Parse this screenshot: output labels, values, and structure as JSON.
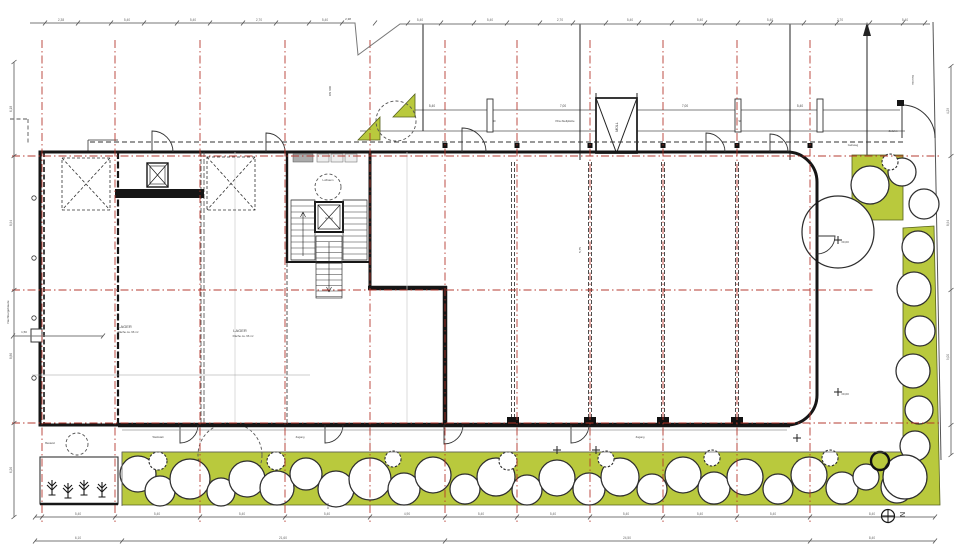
{
  "meta": {
    "drawing_type": "Erdgeschoss Lageplan",
    "north_label": "N"
  },
  "colors": {
    "landscape_green": "#b9c93d",
    "grid_red": "#b23026",
    "wall_black": "#161616",
    "paper_white": "#ffffff"
  },
  "grid": {
    "vertical_axes_x": [
      42,
      115,
      200,
      285,
      370,
      445,
      517,
      590,
      663,
      737,
      810
    ],
    "horizontal_axes": [
      {
        "y": 156,
        "x1": 12,
        "x2": 940
      },
      {
        "y": 290,
        "x1": 12,
        "x2": 875
      },
      {
        "y": 423,
        "x1": 12,
        "x2": 940
      }
    ]
  },
  "building": {
    "partitions_x": [
      513,
      590,
      663,
      737
    ],
    "partition_flags_x": [
      445,
      517,
      590,
      663,
      737,
      810
    ],
    "walkway_dividers_x": [
      200,
      285,
      370,
      445,
      517,
      590,
      663,
      737
    ]
  },
  "yard": {
    "fence_posts_x": [
      487,
      735,
      817
    ]
  },
  "landscape": {
    "tree_row": [
      [
        138,
        474,
        18
      ],
      [
        160,
        491,
        15
      ],
      [
        190,
        479,
        20
      ],
      [
        221,
        492,
        14
      ],
      [
        247,
        479,
        18
      ],
      [
        277,
        488,
        17
      ],
      [
        306,
        474,
        16
      ],
      [
        336,
        489,
        18
      ],
      [
        370,
        479,
        21
      ],
      [
        404,
        489,
        16
      ],
      [
        433,
        475,
        18
      ],
      [
        465,
        489,
        15
      ],
      [
        496,
        477,
        19
      ],
      [
        527,
        490,
        15
      ],
      [
        557,
        478,
        18
      ],
      [
        589,
        489,
        16
      ],
      [
        620,
        477,
        19
      ],
      [
        652,
        489,
        15
      ],
      [
        683,
        475,
        18
      ],
      [
        714,
        488,
        16
      ],
      [
        745,
        477,
        18
      ],
      [
        778,
        489,
        15
      ],
      [
        809,
        475,
        18
      ],
      [
        842,
        488,
        16
      ],
      [
        866,
        477,
        13
      ],
      [
        897,
        487,
        16
      ]
    ],
    "right_trees": [
      [
        838,
        232,
        36
      ],
      [
        870,
        185,
        19
      ],
      [
        902,
        172,
        14
      ],
      [
        924,
        204,
        15
      ],
      [
        918,
        247,
        16
      ],
      [
        914,
        289,
        17
      ],
      [
        920,
        331,
        15
      ],
      [
        913,
        371,
        17
      ],
      [
        919,
        410,
        14
      ],
      [
        915,
        446,
        15
      ],
      [
        905,
        477,
        22
      ]
    ],
    "bushes": [
      [
        158,
        461,
        9
      ],
      [
        276,
        461,
        9
      ],
      [
        393,
        459,
        8
      ],
      [
        508,
        461,
        9
      ],
      [
        606,
        459,
        8
      ],
      [
        712,
        458,
        8
      ],
      [
        830,
        458,
        8
      ],
      [
        890,
        162,
        8
      ]
    ],
    "dark_tree": [
      880,
      461,
      9
    ],
    "existing_trees_dashed": [
      [
        230,
        455,
        32
      ],
      [
        77,
        444,
        11
      ],
      [
        396,
        121,
        20
      ]
    ],
    "planter_plants": [
      [
        52,
        495
      ],
      [
        68,
        498
      ],
      [
        84,
        495
      ],
      [
        102,
        497
      ]
    ]
  },
  "labels": [
    {
      "t": "LAGER",
      "x": 125,
      "y": 328,
      "s": 4
    },
    {
      "t": "Fläche ca. 96 m²",
      "x": 128,
      "y": 333,
      "s": 2.8
    },
    {
      "t": "LAGER",
      "x": 240,
      "y": 332,
      "s": 4
    },
    {
      "t": "Fläche ca. 96 m²",
      "x": 243,
      "y": 337,
      "s": 2.8
    },
    {
      "t": "Luftraum",
      "x": 328,
      "y": 181,
      "s": 2.8
    },
    {
      "t": "Aufzug",
      "x": 329,
      "y": 219,
      "s": 2.6
    },
    {
      "t": "MÜLL",
      "x": 618,
      "y": 127,
      "s": 3.6,
      "r": -90
    },
    {
      "t": "DN 600",
      "x": 331,
      "y": 91,
      "s": 3,
      "r": -90
    },
    {
      "t": "5,75",
      "x": 581,
      "y": 250,
      "s": 3,
      "r": -90
    },
    {
      "t": "0,90",
      "x": 329,
      "y": 506,
      "s": 3,
      "r": -90
    },
    {
      "t": "1,50",
      "x": 24,
      "y": 333,
      "s": 3
    },
    {
      "t": "5,40",
      "x": 432,
      "y": 107,
      "s": 3.2
    },
    {
      "t": "7,00",
      "x": 563,
      "y": 107,
      "s": 3.2
    },
    {
      "t": "7,00",
      "x": 685,
      "y": 107,
      "s": 3.2
    },
    {
      "t": "5,40",
      "x": 800,
      "y": 107,
      "s": 3.2
    },
    {
      "t": "90",
      "x": 494,
      "y": 122,
      "s": 2.8
    },
    {
      "t": "90",
      "x": 740,
      "y": 122,
      "s": 2.8
    },
    {
      "t": "Pkw-Stellplätze",
      "x": 565,
      "y": 122,
      "s": 2.8
    },
    {
      "t": "Gehweg",
      "x": 853,
      "y": 146,
      "s": 2.8
    },
    {
      "t": "Zufahrt",
      "x": 893,
      "y": 132,
      "s": 2.8
    },
    {
      "t": "Grenze",
      "x": 912,
      "y": 80,
      "s": 3,
      "r": 90
    },
    {
      "t": "Nachbargebäude",
      "x": 9,
      "y": 312,
      "s": 3,
      "r": -90
    },
    {
      "t": "Bestand",
      "x": 50,
      "y": 444,
      "s": 2.6
    },
    {
      "t": "±0,00",
      "x": 845,
      "y": 243,
      "s": 3
    },
    {
      "t": "±0,00",
      "x": 845,
      "y": 395,
      "s": 3
    },
    {
      "t": "Werkstatt",
      "x": 158,
      "y": 438,
      "s": 2.6
    },
    {
      "t": "Zugang",
      "x": 300,
      "y": 438,
      "s": 2.6
    },
    {
      "t": "Zugang",
      "x": 640,
      "y": 438,
      "s": 2.6
    },
    {
      "t": "2,38",
      "x": 348,
      "y": 20,
      "s": 3
    }
  ],
  "plus_marks": [
    [
      557,
      450
    ],
    [
      596,
      450
    ],
    [
      838,
      240
    ],
    [
      838,
      392
    ],
    [
      797,
      438
    ]
  ],
  "dimensions": {
    "chains": [
      {
        "name": "top",
        "dir": "h",
        "pos": 23,
        "line": [
          [
            30,
            23
          ],
          [
            355,
            23
          ],
          [
            358,
            55
          ],
          [
            400,
            24
          ],
          [
            930,
            24
          ]
        ],
        "ticks": [
          45,
          78,
          111,
          144,
          177,
          210,
          243,
          276,
          309,
          342,
          375,
          408,
          441,
          474,
          507,
          540,
          573,
          606,
          639,
          672,
          705,
          738,
          771,
          804,
          837,
          870,
          903,
          925
        ],
        "numbers": [
          {
            "v": "2,38",
            "p": 61
          },
          {
            "v": "5,40",
            "p": 127
          },
          {
            "v": "5,40",
            "p": 193
          },
          {
            "v": "2,70",
            "p": 259
          },
          {
            "v": "5,40",
            "p": 325
          },
          {
            "v": "5,40",
            "p": 420
          },
          {
            "v": "5,40",
            "p": 490
          },
          {
            "v": "2,70",
            "p": 560
          },
          {
            "v": "5,40",
            "p": 630
          },
          {
            "v": "5,40",
            "p": 700
          },
          {
            "v": "5,40",
            "p": 770
          },
          {
            "v": "2,70",
            "p": 840
          },
          {
            "v": "5,40",
            "p": 905
          }
        ]
      },
      {
        "name": "bottom-1",
        "dir": "h",
        "pos": 517,
        "line": [
          [
            35,
            517
          ],
          [
            935,
            517
          ]
        ],
        "ticks": [
          35,
          42,
          115,
          200,
          285,
          370,
          445,
          517,
          590,
          663,
          737,
          810,
          935
        ],
        "numbers": [
          {
            "v": "5,40",
            "p": 78
          },
          {
            "v": "5,40",
            "p": 157
          },
          {
            "v": "5,40",
            "p": 242
          },
          {
            "v": "5,40",
            "p": 327
          },
          {
            "v": "4,90",
            "p": 407
          },
          {
            "v": "5,40",
            "p": 481
          },
          {
            "v": "5,40",
            "p": 553
          },
          {
            "v": "5,40",
            "p": 626
          },
          {
            "v": "5,40",
            "p": 700
          },
          {
            "v": "5,40",
            "p": 773
          },
          {
            "v": "8,40",
            "p": 872
          }
        ]
      },
      {
        "name": "bottom-2",
        "dir": "h",
        "pos": 541,
        "line": [
          [
            35,
            541
          ],
          [
            935,
            541
          ]
        ],
        "ticks": [
          35,
          122,
          445,
          810,
          935
        ],
        "numbers": [
          {
            "v": "6,10",
            "p": 78
          },
          {
            "v": "21,60",
            "p": 283
          },
          {
            "v": "24,50",
            "p": 627
          },
          {
            "v": "8,40",
            "p": 872
          }
        ]
      },
      {
        "name": "left",
        "dir": "v",
        "pos": 14,
        "line": [
          [
            14,
            62
          ],
          [
            14,
            517
          ]
        ],
        "ticks": [
          62,
          156,
          290,
          423,
          517
        ],
        "numbers": [
          {
            "v": "6,18",
            "p": 109
          },
          {
            "v": "8,94",
            "p": 223
          },
          {
            "v": "8,86",
            "p": 356
          },
          {
            "v": "6,26",
            "p": 470
          }
        ]
      },
      {
        "name": "right",
        "dir": "v",
        "pos": 951,
        "line": [
          [
            951,
            66
          ],
          [
            951,
            455
          ]
        ],
        "ticks": [
          66,
          156,
          290,
          425,
          455
        ],
        "numbers": [
          {
            "v": "4,29",
            "p": 111
          },
          {
            "v": "8,94",
            "p": 223
          },
          {
            "v": "9,00",
            "p": 357
          }
        ]
      }
    ],
    "small_dim": {
      "label": "1,50",
      "x1": 13,
      "x2": 103,
      "y": 336
    }
  },
  "north": {
    "label": "N"
  }
}
